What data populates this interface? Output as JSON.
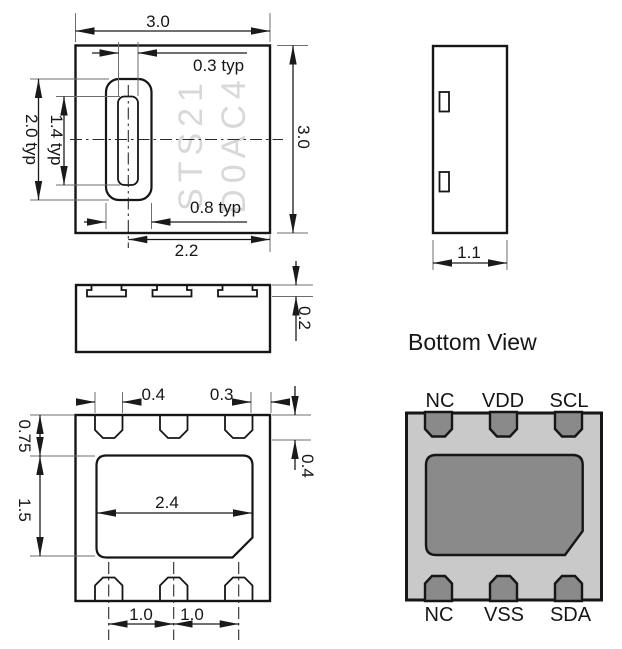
{
  "views": {
    "top": {
      "marking_line1": "STS21",
      "marking_line2": "D0AC4",
      "dims": {
        "width": "3.0",
        "height": "3.0",
        "slot_inner_width": "0.3 typ",
        "slot_outer_width": "0.8 typ",
        "slot_outer_height": "2.0 typ",
        "slot_inner_height": "1.4 typ",
        "slot_center_to_edge": "2.2"
      }
    },
    "front": {
      "dims": {
        "pad_thickness": "0.2"
      }
    },
    "side": {
      "dims": {
        "depth": "1.1"
      }
    },
    "bottom": {
      "dims": {
        "pad_width": "0.4",
        "pad_to_edge": "0.3",
        "pad_depth": "0.4",
        "die_pad_offset": "0.75",
        "die_pad_height": "1.5",
        "die_pad_width": "2.4",
        "pad_pitch_left": "1.0",
        "pad_pitch_right": "1.0"
      }
    },
    "pinout": {
      "title": "Bottom View",
      "top_pins": [
        "NC",
        "VDD",
        "SCL"
      ],
      "bottom_pins": [
        "NC",
        "VSS",
        "SDA"
      ]
    }
  },
  "colors": {
    "line": "#161616",
    "package_body": "#c9c9c9",
    "pad": "#8a8a8a",
    "marking": "#d8d8d8"
  }
}
